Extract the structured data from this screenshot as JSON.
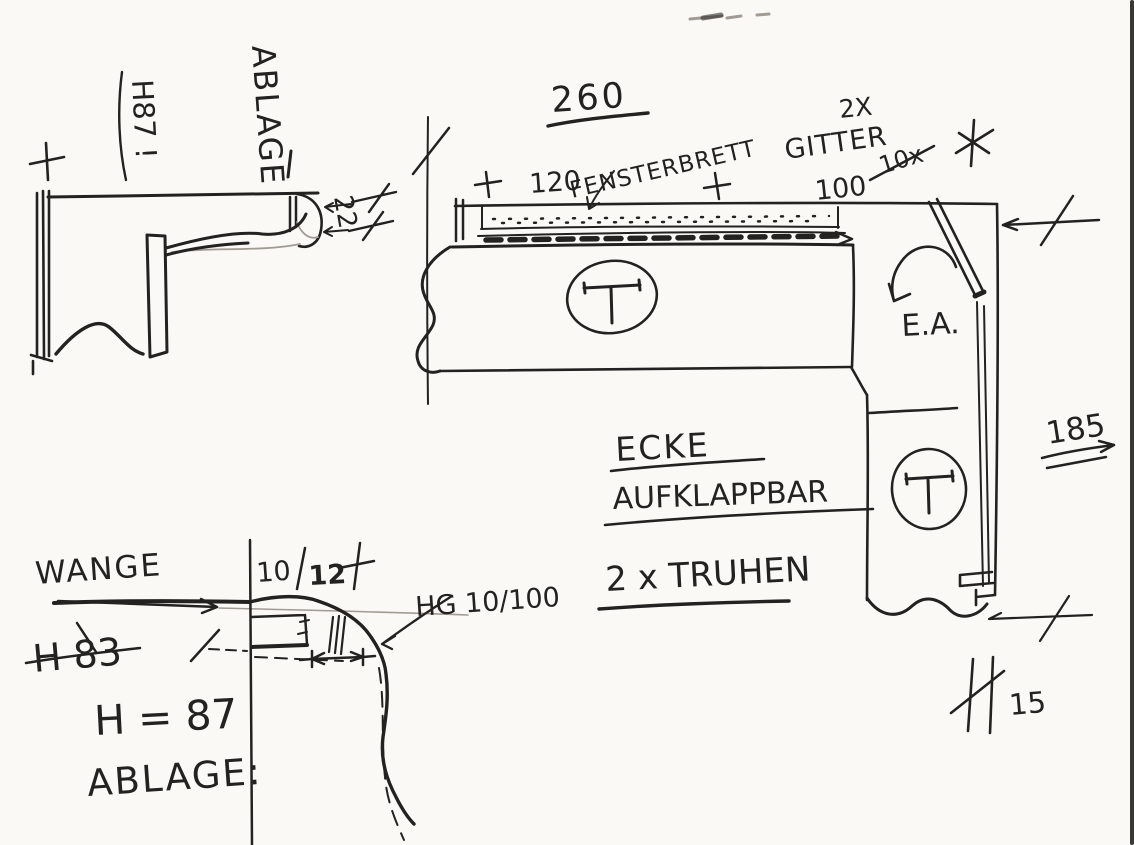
{
  "colors": {
    "paper": "#faf9f6",
    "ink": "#242220",
    "faint": "#a09c93"
  },
  "side_view": {
    "shelf_label": "ABLAGE",
    "height_label": "H87 !",
    "thickness_label": "22"
  },
  "plan": {
    "overall_width": "260",
    "window_width": "120",
    "window_sill_label": "FENSTERBRETT",
    "grille_count": "2X",
    "grille_label": "GITTER",
    "grille_crossed_out": "10x",
    "grille_size": "100",
    "chest_mark_left": "T",
    "chest_mark_right": "T",
    "corner_abbreviation": "E.A.",
    "depth_label": "185",
    "corner_note_line1": "ECKE",
    "corner_note_line2": "AUFKLAPPBAR",
    "chests_note": "2 x TRUHEN",
    "offset_label": "15"
  },
  "detail": {
    "side_panel_label": "WANGE",
    "dim_left": "10",
    "dim_right": "12",
    "rail_label": "HG 10/100",
    "crossed_height": "H 83",
    "height_note": "H = 87",
    "shelf_note": "ABLAGE:"
  }
}
